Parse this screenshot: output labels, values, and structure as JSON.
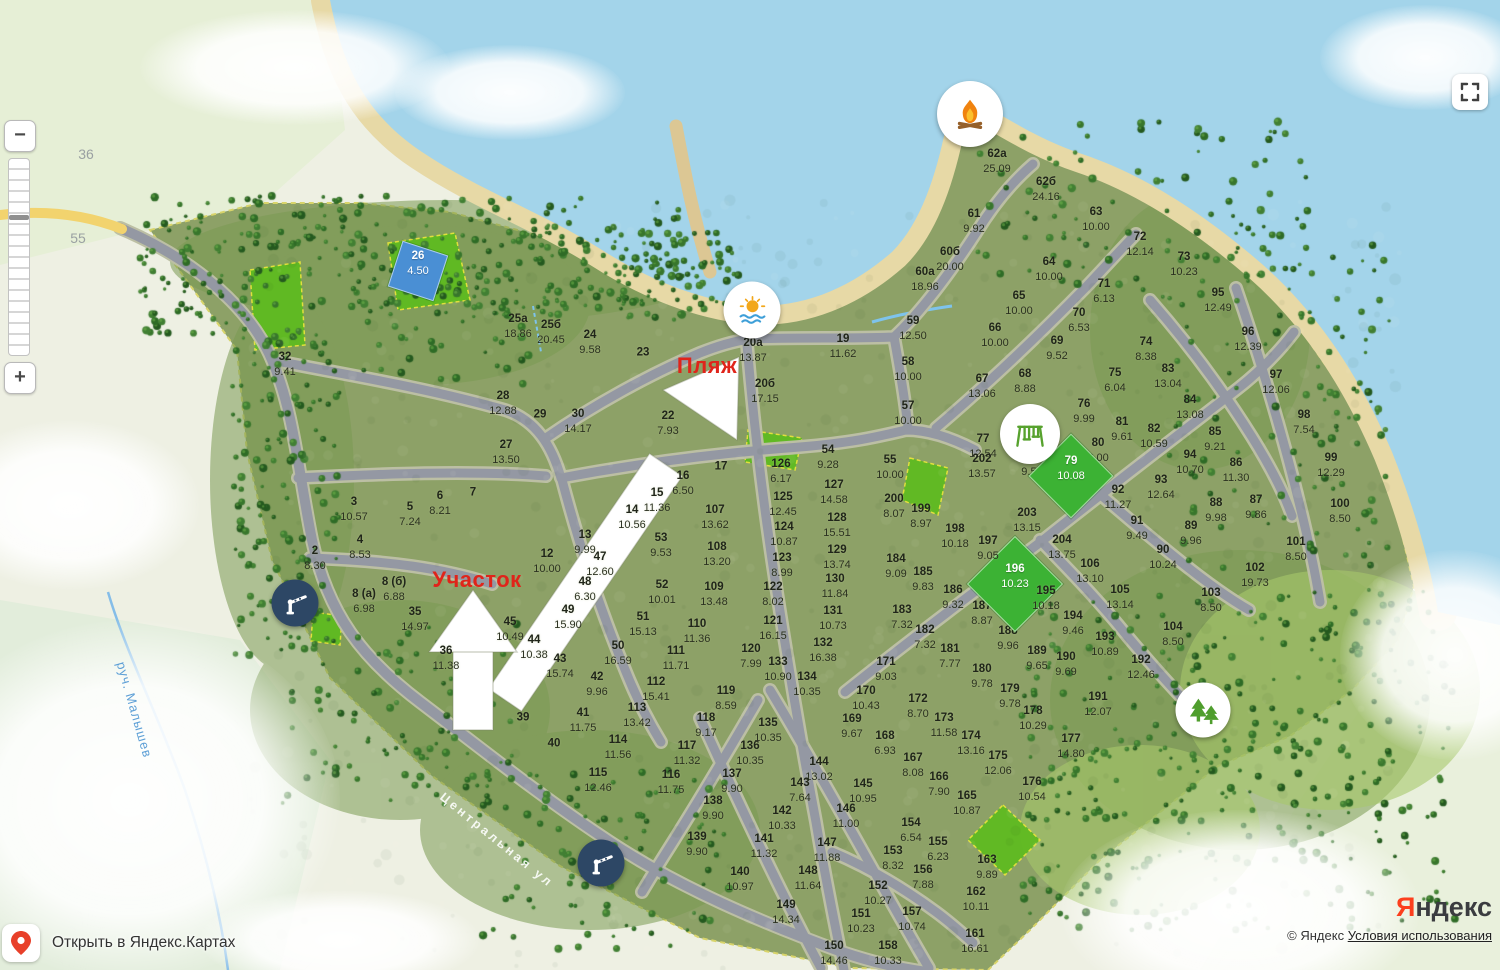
{
  "ui": {
    "zoom_out": "−",
    "zoom_in": "+",
    "open_in": "Открыть в Яндекс.Картах",
    "logo_first": "Я",
    "logo_rest": "ндекс",
    "copyright": "© Яндекс",
    "terms": "Условия использования"
  },
  "colors": {
    "annotation_red": "#e0241a",
    "highlight_green": "#3cb234",
    "highlight_blue": "#4a8fd4",
    "barrier_navy": "#2d4765",
    "water": "#a3d4ea",
    "sand": "#e7d9a6",
    "village_green": "#8da167",
    "park_green": "#5fbb21",
    "road_gray": "#9498a3"
  },
  "map": {
    "street_label": "Центральная ул",
    "stream_label": "руч. Малышев",
    "road_numbers": {
      "a": "36",
      "b": "55"
    },
    "annotations": {
      "beach": "Пляж",
      "plot": "Участок"
    },
    "poi": [
      {
        "name": "campfire",
        "x": 970,
        "y": 114,
        "d": 66
      },
      {
        "name": "beach",
        "x": 752,
        "y": 310,
        "d": 57
      },
      {
        "name": "playground",
        "x": 1030,
        "y": 434,
        "d": 60
      },
      {
        "name": "park",
        "x": 1203,
        "y": 710,
        "d": 55
      },
      {
        "name": "barrier",
        "x": 295,
        "y": 603,
        "d": 47
      },
      {
        "name": "barrier",
        "x": 601,
        "y": 863,
        "d": 47
      }
    ],
    "plots": [
      {
        "n": "62а",
        "a": "25.09",
        "x": 997,
        "y": 160
      },
      {
        "n": "62б",
        "a": "24.16",
        "x": 1046,
        "y": 188
      },
      {
        "n": "61",
        "a": "9.92",
        "x": 974,
        "y": 220
      },
      {
        "n": "63",
        "a": "10.00",
        "x": 1096,
        "y": 218
      },
      {
        "n": "72",
        "a": "12.14",
        "x": 1140,
        "y": 243
      },
      {
        "n": "60б",
        "a": "20.00",
        "x": 950,
        "y": 258
      },
      {
        "n": "73",
        "a": "10.23",
        "x": 1184,
        "y": 263
      },
      {
        "n": "64",
        "a": "10.00",
        "x": 1049,
        "y": 268
      },
      {
        "n": "60а",
        "a": "18.96",
        "x": 925,
        "y": 278
      },
      {
        "n": "95",
        "a": "12.49",
        "x": 1218,
        "y": 299
      },
      {
        "n": "71",
        "a": "6.13",
        "x": 1104,
        "y": 290
      },
      {
        "n": "65",
        "a": "10.00",
        "x": 1019,
        "y": 302
      },
      {
        "n": "70",
        "a": "6.53",
        "x": 1079,
        "y": 319
      },
      {
        "n": "96",
        "a": "12.39",
        "x": 1248,
        "y": 338
      },
      {
        "n": "66",
        "a": "10.00",
        "x": 995,
        "y": 334
      },
      {
        "n": "69",
        "a": "9.52",
        "x": 1057,
        "y": 347
      },
      {
        "n": "59",
        "a": "12.50",
        "x": 913,
        "y": 327
      },
      {
        "n": "58",
        "a": "10.00",
        "x": 908,
        "y": 368
      },
      {
        "n": "68",
        "a": "8.88",
        "x": 1025,
        "y": 380
      },
      {
        "n": "67",
        "a": "13.06",
        "x": 982,
        "y": 385
      },
      {
        "n": "74",
        "a": "8.38",
        "x": 1146,
        "y": 348
      },
      {
        "n": "83",
        "a": "13.04",
        "x": 1168,
        "y": 375
      },
      {
        "n": "97",
        "a": "12.06",
        "x": 1276,
        "y": 381
      },
      {
        "n": "57",
        "a": "10.00",
        "x": 908,
        "y": 412
      },
      {
        "n": "75",
        "a": "6.04",
        "x": 1115,
        "y": 379
      },
      {
        "n": "76",
        "a": "9.99",
        "x": 1084,
        "y": 410
      },
      {
        "n": "84",
        "a": "13.08",
        "x": 1190,
        "y": 406
      },
      {
        "n": "82",
        "a": "10.59",
        "x": 1154,
        "y": 435
      },
      {
        "n": "98",
        "a": "7.54",
        "x": 1304,
        "y": 421
      },
      {
        "n": "77",
        "a": "12.54",
        "x": 983,
        "y": 445
      },
      {
        "n": "81",
        "a": "9.61",
        "x": 1122,
        "y": 428
      },
      {
        "n": "80",
        "a": "6.00",
        "x": 1098,
        "y": 449
      },
      {
        "n": "85",
        "a": "9.21",
        "x": 1215,
        "y": 438
      },
      {
        "n": "78",
        "a": "9.56",
        "x": 1032,
        "y": 463
      },
      {
        "n": "79",
        "a": "10.08",
        "x": 1071,
        "y": 467,
        "h": "green",
        "s": 58
      },
      {
        "n": "94",
        "a": "10.70",
        "x": 1190,
        "y": 461
      },
      {
        "n": "86",
        "a": "11.30",
        "x": 1236,
        "y": 469
      },
      {
        "n": "93",
        "a": "12.64",
        "x": 1161,
        "y": 486
      },
      {
        "n": "92",
        "a": "11.27",
        "x": 1118,
        "y": 496
      },
      {
        "n": "99",
        "a": "12.29",
        "x": 1331,
        "y": 464
      },
      {
        "n": "87",
        "a": "9.86",
        "x": 1256,
        "y": 506
      },
      {
        "n": "91",
        "a": "9.49",
        "x": 1137,
        "y": 527
      },
      {
        "n": "88",
        "a": "9.98",
        "x": 1216,
        "y": 509
      },
      {
        "n": "89",
        "a": "9.96",
        "x": 1191,
        "y": 532
      },
      {
        "n": "100",
        "a": "8.50",
        "x": 1340,
        "y": 510
      },
      {
        "n": "90",
        "a": "10.24",
        "x": 1163,
        "y": 556
      },
      {
        "n": "202",
        "a": "13.57",
        "x": 982,
        "y": 465
      },
      {
        "n": "203",
        "a": "13.15",
        "x": 1027,
        "y": 519
      },
      {
        "n": "204",
        "a": "13.75",
        "x": 1062,
        "y": 546
      },
      {
        "n": "101",
        "a": "8.50",
        "x": 1296,
        "y": 548
      },
      {
        "n": "106",
        "a": "13.10",
        "x": 1090,
        "y": 570
      },
      {
        "n": "102",
        "a": "19.73",
        "x": 1255,
        "y": 574
      },
      {
        "n": "105",
        "a": "13.14",
        "x": 1120,
        "y": 596
      },
      {
        "n": "103",
        "a": "8.50",
        "x": 1211,
        "y": 599
      },
      {
        "n": "104",
        "a": "8.50",
        "x": 1173,
        "y": 633
      },
      {
        "n": "192",
        "a": "12.46",
        "x": 1141,
        "y": 666
      },
      {
        "n": "191",
        "a": "12.07",
        "x": 1098,
        "y": 703
      },
      {
        "n": "190",
        "a": "9.69",
        "x": 1066,
        "y": 663
      },
      {
        "n": "189",
        "a": "9.65",
        "x": 1037,
        "y": 657
      },
      {
        "n": "188",
        "a": "9.96",
        "x": 1008,
        "y": 637
      },
      {
        "n": "187",
        "a": "8.87",
        "x": 982,
        "y": 612
      },
      {
        "n": "196",
        "a": "10.23",
        "x": 1015,
        "y": 575,
        "h": "green",
        "s": 66
      },
      {
        "n": "195",
        "a": "10.18",
        "x": 1046,
        "y": 597
      },
      {
        "n": "194",
        "a": "9.46",
        "x": 1073,
        "y": 622
      },
      {
        "n": "193",
        "a": "10.89",
        "x": 1105,
        "y": 643
      },
      {
        "n": "198",
        "a": "10.18",
        "x": 955,
        "y": 535
      },
      {
        "n": "197",
        "a": "9.05",
        "x": 988,
        "y": 547
      },
      {
        "n": "199",
        "a": "8.97",
        "x": 921,
        "y": 515
      },
      {
        "n": "200",
        "a": "8.07",
        "x": 894,
        "y": 505
      },
      {
        "n": "184",
        "a": "9.09",
        "x": 896,
        "y": 565
      },
      {
        "n": "185",
        "a": "9.83",
        "x": 923,
        "y": 578
      },
      {
        "n": "186",
        "a": "9.32",
        "x": 953,
        "y": 596
      },
      {
        "n": "183",
        "a": "7.32",
        "x": 902,
        "y": 616
      },
      {
        "n": "182",
        "a": "7.32",
        "x": 925,
        "y": 636
      },
      {
        "n": "181",
        "a": "7.77",
        "x": 950,
        "y": 655
      },
      {
        "n": "180",
        "a": "9.78",
        "x": 982,
        "y": 675
      },
      {
        "n": "179",
        "a": "9.78",
        "x": 1010,
        "y": 695
      },
      {
        "n": "178",
        "a": "10.29",
        "x": 1033,
        "y": 717
      },
      {
        "n": "177",
        "a": "14.80",
        "x": 1071,
        "y": 745
      },
      {
        "n": "176",
        "a": "10.54",
        "x": 1032,
        "y": 788
      },
      {
        "n": "175",
        "a": "12.06",
        "x": 998,
        "y": 762
      },
      {
        "n": "174",
        "a": "13.16",
        "x": 971,
        "y": 742
      },
      {
        "n": "173",
        "a": "11.58",
        "x": 944,
        "y": 724
      },
      {
        "n": "172",
        "a": "8.70",
        "x": 918,
        "y": 705
      },
      {
        "n": "171",
        "a": "9.03",
        "x": 886,
        "y": 668
      },
      {
        "n": "170",
        "a": "10.43",
        "x": 866,
        "y": 697
      },
      {
        "n": "169",
        "a": "9.67",
        "x": 852,
        "y": 725
      },
      {
        "n": "168",
        "a": "6.93",
        "x": 885,
        "y": 742
      },
      {
        "n": "167",
        "a": "8.08",
        "x": 913,
        "y": 764
      },
      {
        "n": "166",
        "a": "7.90",
        "x": 939,
        "y": 783
      },
      {
        "n": "165",
        "a": "10.87",
        "x": 967,
        "y": 802
      },
      {
        "n": "163",
        "a": "9.89",
        "x": 987,
        "y": 866
      },
      {
        "n": "162",
        "a": "10.11",
        "x": 976,
        "y": 898
      },
      {
        "n": "161",
        "a": "16.61",
        "x": 975,
        "y": 940
      },
      {
        "n": "158",
        "a": "10.33",
        "x": 888,
        "y": 952
      },
      {
        "n": "157",
        "a": "10.74",
        "x": 912,
        "y": 918
      },
      {
        "n": "156",
        "a": "7.88",
        "x": 923,
        "y": 876
      },
      {
        "n": "155",
        "a": "6.23",
        "x": 938,
        "y": 848
      },
      {
        "n": "154",
        "a": "6.54",
        "x": 911,
        "y": 829
      },
      {
        "n": "153",
        "a": "8.32",
        "x": 893,
        "y": 857
      },
      {
        "n": "152",
        "a": "10.27",
        "x": 878,
        "y": 892
      },
      {
        "n": "151",
        "a": "10.23",
        "x": 861,
        "y": 920
      },
      {
        "n": "150",
        "a": "14.46",
        "x": 834,
        "y": 952
      },
      {
        "n": "149",
        "a": "14.34",
        "x": 786,
        "y": 911
      },
      {
        "n": "148",
        "a": "11.64",
        "x": 808,
        "y": 877
      },
      {
        "n": "147",
        "a": "11.88",
        "x": 827,
        "y": 849
      },
      {
        "n": "146",
        "a": "11.00",
        "x": 846,
        "y": 815
      },
      {
        "n": "145",
        "a": "10.95",
        "x": 863,
        "y": 790
      },
      {
        "n": "144",
        "a": "13.02",
        "x": 819,
        "y": 768
      },
      {
        "n": "143",
        "a": "7.64",
        "x": 800,
        "y": 789
      },
      {
        "n": "142",
        "a": "10.33",
        "x": 782,
        "y": 817
      },
      {
        "n": "141",
        "a": "11.32",
        "x": 764,
        "y": 845
      },
      {
        "n": "140",
        "a": "10.97",
        "x": 740,
        "y": 878
      },
      {
        "n": "139",
        "a": "9.90",
        "x": 697,
        "y": 843
      },
      {
        "n": "138",
        "a": "9.90",
        "x": 713,
        "y": 807
      },
      {
        "n": "137",
        "a": "9.90",
        "x": 732,
        "y": 780
      },
      {
        "n": "136",
        "a": "10.35",
        "x": 750,
        "y": 752
      },
      {
        "n": "135",
        "a": "10.35",
        "x": 768,
        "y": 729
      },
      {
        "n": "134",
        "a": "10.35",
        "x": 807,
        "y": 683
      },
      {
        "n": "133",
        "a": "10.90",
        "x": 778,
        "y": 668
      },
      {
        "n": "120",
        "a": "7.99",
        "x": 751,
        "y": 655
      },
      {
        "n": "121",
        "a": "16.15",
        "x": 773,
        "y": 627
      },
      {
        "n": "122",
        "a": "8.02",
        "x": 773,
        "y": 593
      },
      {
        "n": "119",
        "a": "8.59",
        "x": 726,
        "y": 697
      },
      {
        "n": "118",
        "a": "9.17",
        "x": 706,
        "y": 724
      },
      {
        "n": "117",
        "a": "11.32",
        "x": 687,
        "y": 752
      },
      {
        "n": "116",
        "a": "11.75",
        "x": 671,
        "y": 781
      },
      {
        "n": "115",
        "a": "12.46",
        "x": 598,
        "y": 779
      },
      {
        "n": "114",
        "a": "11.56",
        "x": 618,
        "y": 746
      },
      {
        "n": "113",
        "a": "13.42",
        "x": 637,
        "y": 714
      },
      {
        "n": "112",
        "a": "15.41",
        "x": 656,
        "y": 688
      },
      {
        "n": "111",
        "a": "11.71",
        "x": 676,
        "y": 657
      },
      {
        "n": "110",
        "a": "11.36",
        "x": 697,
        "y": 630
      },
      {
        "n": "109",
        "a": "13.48",
        "x": 714,
        "y": 593
      },
      {
        "n": "108",
        "a": "13.20",
        "x": 717,
        "y": 553
      },
      {
        "n": "107",
        "a": "13.62",
        "x": 715,
        "y": 516
      },
      {
        "n": "53",
        "a": "9.53",
        "x": 661,
        "y": 544
      },
      {
        "n": "52",
        "a": "10.01",
        "x": 662,
        "y": 591
      },
      {
        "n": "51",
        "a": "15.13",
        "x": 643,
        "y": 623
      },
      {
        "n": "50",
        "a": "16.59",
        "x": 618,
        "y": 652
      },
      {
        "n": "47",
        "a": "12.60",
        "x": 600,
        "y": 563
      },
      {
        "n": "48",
        "a": "6.30",
        "x": 585,
        "y": 588
      },
      {
        "n": "49",
        "a": "15.90",
        "x": 568,
        "y": 616
      },
      {
        "n": "45",
        "a": "10.49",
        "x": 510,
        "y": 628
      },
      {
        "n": "44",
        "a": "10.38",
        "x": 534,
        "y": 646
      },
      {
        "n": "43",
        "a": "15.74",
        "x": 560,
        "y": 665
      },
      {
        "n": "42",
        "a": "9.96",
        "x": 597,
        "y": 683
      },
      {
        "n": "41",
        "a": "11.75",
        "x": 583,
        "y": 719
      },
      {
        "n": "39",
        "a": "",
        "x": 523,
        "y": 717
      },
      {
        "n": "40",
        "a": "",
        "x": 554,
        "y": 743
      },
      {
        "n": "36",
        "a": "11.38",
        "x": 446,
        "y": 657
      },
      {
        "n": "35",
        "a": "14.97",
        "x": 415,
        "y": 618
      },
      {
        "n": "8 (б)",
        "a": "6.88",
        "x": 394,
        "y": 588
      },
      {
        "n": "8 (а)",
        "a": "6.98",
        "x": 364,
        "y": 600
      },
      {
        "n": "2",
        "a": "8.30",
        "x": 315,
        "y": 557
      },
      {
        "n": "4",
        "a": "8.53",
        "x": 360,
        "y": 546
      },
      {
        "n": "3",
        "a": "10.57",
        "x": 354,
        "y": 508
      },
      {
        "n": "5",
        "a": "7.24",
        "x": 410,
        "y": 513
      },
      {
        "n": "6",
        "a": "8.21",
        "x": 440,
        "y": 502
      },
      {
        "n": "7",
        "a": "",
        "x": 473,
        "y": 492
      },
      {
        "n": "12",
        "a": "10.00",
        "x": 547,
        "y": 560
      },
      {
        "n": "13",
        "a": "9.99",
        "x": 585,
        "y": 541
      },
      {
        "n": "14",
        "a": "10.56",
        "x": 632,
        "y": 516
      },
      {
        "n": "15",
        "a": "11.36",
        "x": 657,
        "y": 499
      },
      {
        "n": "16",
        "a": "6.50",
        "x": 683,
        "y": 482
      },
      {
        "n": "17",
        "a": "",
        "x": 721,
        "y": 466
      },
      {
        "n": "22",
        "a": "7.93",
        "x": 668,
        "y": 422
      },
      {
        "n": "23",
        "a": "",
        "x": 643,
        "y": 352
      },
      {
        "n": "24",
        "a": "9.58",
        "x": 590,
        "y": 341
      },
      {
        "n": "25а",
        "a": "18.86",
        "x": 518,
        "y": 325
      },
      {
        "n": "25б",
        "a": "20.45",
        "x": 551,
        "y": 331
      },
      {
        "n": "28",
        "a": "12.88",
        "x": 503,
        "y": 402
      },
      {
        "n": "29",
        "a": "",
        "x": 540,
        "y": 414
      },
      {
        "n": "30",
        "a": "14.17",
        "x": 578,
        "y": 420
      },
      {
        "n": "27",
        "a": "13.50",
        "x": 506,
        "y": 451
      },
      {
        "n": "26",
        "a": "4.50",
        "x": 418,
        "y": 262,
        "h": "blue",
        "s": 46,
        "r": 18
      },
      {
        "n": "32",
        "a": "9.41",
        "x": 285,
        "y": 363
      },
      {
        "n": "20а",
        "a": "13.87",
        "x": 753,
        "y": 349
      },
      {
        "n": "20б",
        "a": "17.15",
        "x": 765,
        "y": 390
      },
      {
        "n": "19",
        "a": "11.62",
        "x": 843,
        "y": 345
      },
      {
        "n": "54",
        "a": "9.28",
        "x": 828,
        "y": 456
      },
      {
        "n": "55",
        "a": "10.00",
        "x": 890,
        "y": 466
      },
      {
        "n": "126",
        "a": "6.17",
        "x": 781,
        "y": 470
      },
      {
        "n": "127",
        "a": "14.58",
        "x": 834,
        "y": 491
      },
      {
        "n": "125",
        "a": "12.45",
        "x": 783,
        "y": 503
      },
      {
        "n": "128",
        "a": "15.51",
        "x": 837,
        "y": 524
      },
      {
        "n": "124",
        "a": "10.87",
        "x": 784,
        "y": 533
      },
      {
        "n": "129",
        "a": "13.74",
        "x": 837,
        "y": 556
      },
      {
        "n": "123",
        "a": "8.99",
        "x": 782,
        "y": 564
      },
      {
        "n": "130",
        "a": "11.84",
        "x": 835,
        "y": 585
      },
      {
        "n": "131",
        "a": "10.73",
        "x": 833,
        "y": 617
      },
      {
        "n": "132",
        "a": "16.38",
        "x": 823,
        "y": 649
      }
    ]
  }
}
